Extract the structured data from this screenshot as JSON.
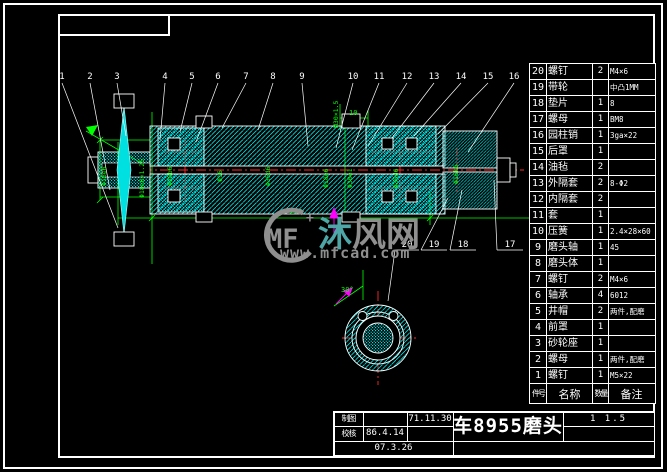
{
  "drawing": {
    "watermark": {
      "logo": "MF",
      "sparkle": "+",
      "brand_char_teal": "沐",
      "brand_chars_gray": "风网",
      "url": "www.mfcad.com"
    },
    "balloons_top": [
      "1",
      "2",
      "3",
      "4",
      "5",
      "6",
      "7",
      "8",
      "9",
      "10",
      "11",
      "12",
      "13",
      "14",
      "15",
      "16"
    ],
    "balloons_bottom": [
      "20",
      "19",
      "18",
      "17"
    ],
    "dims": {
      "overall": "278",
      "top_small": "10",
      "angle": "30°",
      "labels": [
        "Φ16e6",
        "Φ18e6×1.25",
        "Φ28b6",
        "Φ16",
        "Φ35d6",
        "M30×1.5",
        "Φ18e6",
        "Φ30e1",
        "Φ35d6",
        "Φ16k6"
      ]
    }
  },
  "parts_table": {
    "headers": [
      "件号",
      "名称",
      "数量",
      "备注"
    ],
    "rows": [
      {
        "no": "20",
        "name": "螺钉",
        "qty": "2",
        "remark": "M4×6"
      },
      {
        "no": "19",
        "name": "带轮",
        "qty": "",
        "remark": "中凸1MM"
      },
      {
        "no": "18",
        "name": "垫片",
        "qty": "1",
        "remark": "8"
      },
      {
        "no": "17",
        "name": "螺母",
        "qty": "1",
        "remark": "BM8"
      },
      {
        "no": "16",
        "name": "园柱销",
        "qty": "1",
        "remark": "3ga×22"
      },
      {
        "no": "15",
        "name": "后罩",
        "qty": "1",
        "remark": ""
      },
      {
        "no": "14",
        "name": "油毡",
        "qty": "2",
        "remark": ""
      },
      {
        "no": "13",
        "name": "外隔套",
        "qty": "2",
        "remark": "8-Φ2"
      },
      {
        "no": "12",
        "name": "内隔套",
        "qty": "2",
        "remark": ""
      },
      {
        "no": "11",
        "name": "套",
        "qty": "1",
        "remark": ""
      },
      {
        "no": "10",
        "name": "压簧",
        "qty": "1",
        "remark": "2.4×28×60"
      },
      {
        "no": "9",
        "name": "磨头轴",
        "qty": "1",
        "remark": "45"
      },
      {
        "no": "8",
        "name": "磨头体",
        "qty": "1",
        "remark": ""
      },
      {
        "no": "7",
        "name": "螺钉",
        "qty": "2",
        "remark": "M4×6"
      },
      {
        "no": "6",
        "name": "轴承",
        "qty": "4",
        "remark": "6012"
      },
      {
        "no": "5",
        "name": "井帽",
        "qty": "2",
        "remark": "两件,配磨"
      },
      {
        "no": "4",
        "name": "前罩",
        "qty": "1",
        "remark": ""
      },
      {
        "no": "3",
        "name": "砂轮座",
        "qty": "1",
        "remark": ""
      },
      {
        "no": "2",
        "name": "螺母",
        "qty": "1",
        "remark": "两件,配磨"
      },
      {
        "no": "1",
        "name": "螺钉",
        "qty": "1",
        "remark": "M5×22"
      }
    ]
  },
  "title_block": {
    "row1_label": "制图",
    "row1_date": "71.11.30",
    "row2_label": "校核",
    "row2_date": "86.4.14",
    "row3_date": "07.3.26",
    "title": "车8955磨头",
    "scale": "1 1.5"
  },
  "colors": {
    "hatch": "#00e0e0",
    "dimension": "#00ff00",
    "centerline": "#ff2a2a",
    "magenta": "#ff00ff",
    "watermark_gray": "#8f8f8f",
    "watermark_teal": "#4ea6a6",
    "frame": "#ffffff"
  }
}
